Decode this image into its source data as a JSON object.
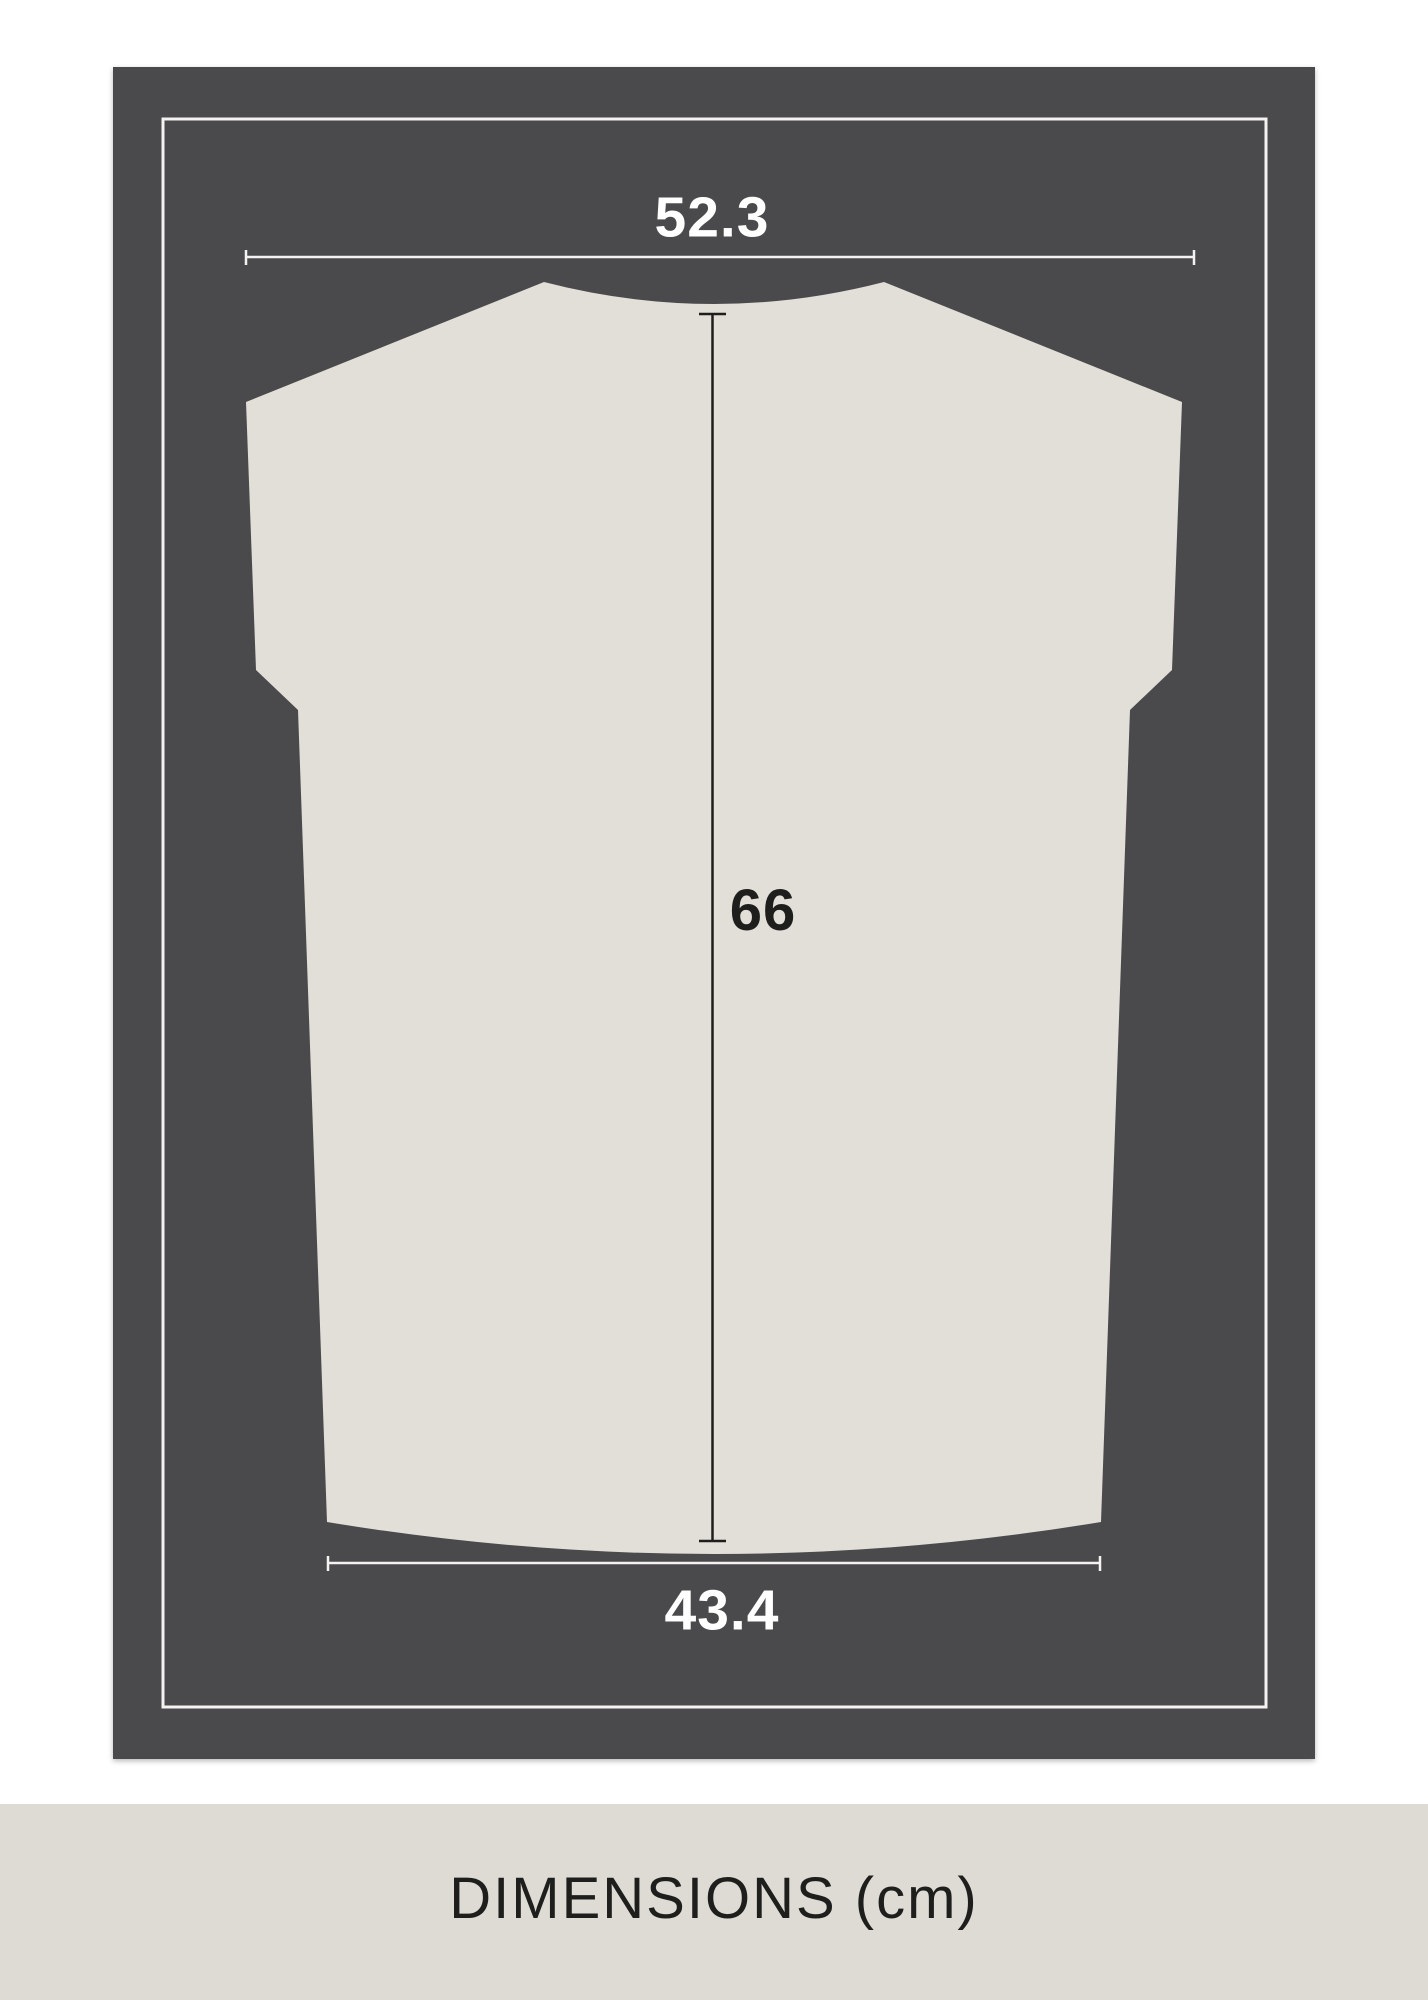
{
  "diagram": {
    "title": "garment back dimensions diagram",
    "garment_type": "t-shirt back silhouette",
    "measurements": {
      "width_top": "52.3",
      "length": "66",
      "width_bottom": "43.4"
    },
    "colors": {
      "page_bg": "#ffffff",
      "card_bg": "#4a4a4c",
      "frame_line": "#f4f3f1",
      "garment_fill": "#e2dfd9",
      "dim_line_light": "#f4f3f1",
      "dim_line_dark": "#1e1e1d"
    }
  },
  "footer": {
    "caption": "DIMENSIONS (cm)",
    "bg": "#dedbd4",
    "text_color": "#1e1e1d"
  }
}
